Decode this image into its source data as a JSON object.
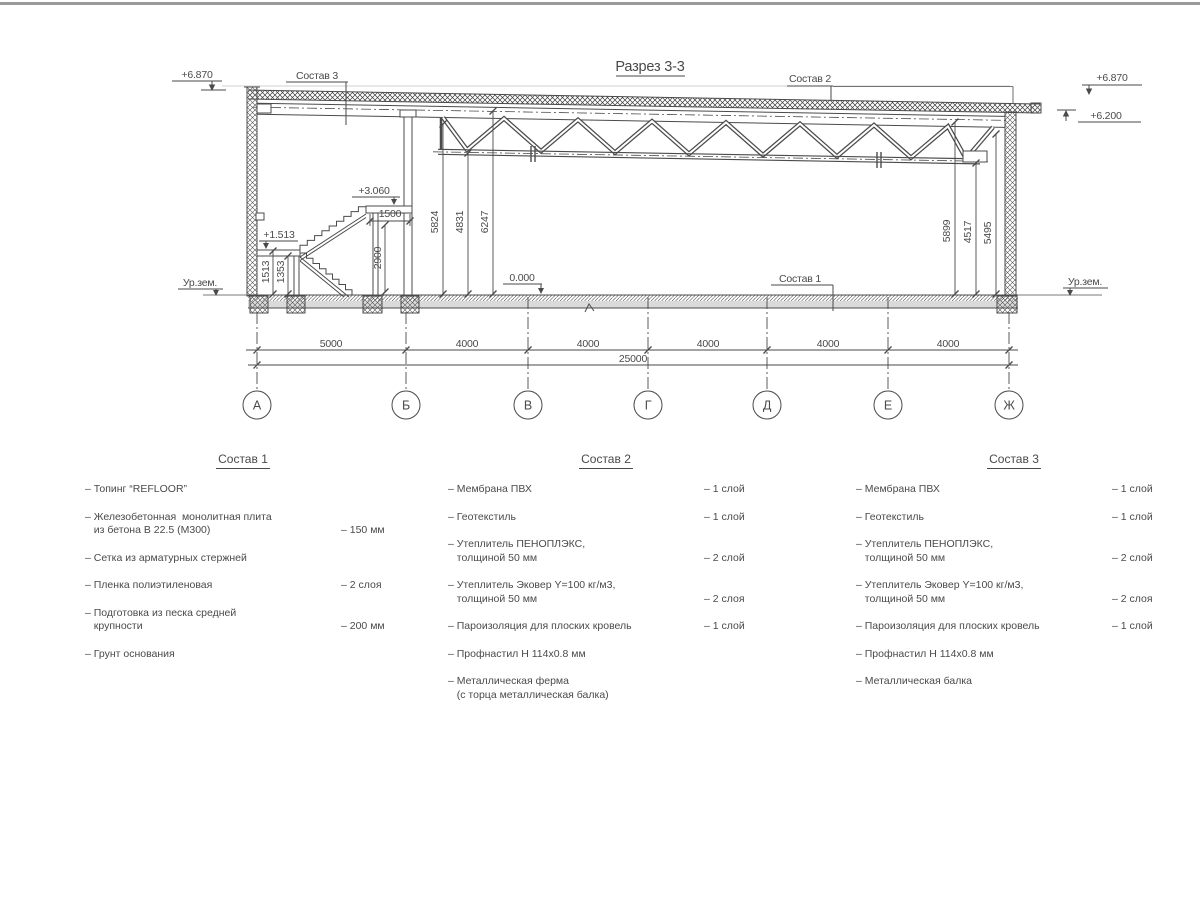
{
  "drawing": {
    "title": "Разрез 3-3",
    "axes": [
      "А",
      "Б",
      "В",
      "Г",
      "Д",
      "Е",
      "Ж"
    ],
    "axis_dims": [
      "5000",
      "4000",
      "4000",
      "4000",
      "4000",
      "4000"
    ],
    "total_dim": "25000",
    "elev_left_top": "+6.870",
    "elev_right_top": "+6.870",
    "elev_right_eave": "+6.200",
    "elev_landing": "+3.060",
    "elev_mid_landing": "+1.513",
    "elev_floor": "0.000",
    "ground_left": "Ур.зем.",
    "ground_right": "Ур.зем.",
    "label_sostav1": "Состав 1",
    "label_sostav2": "Состав 2",
    "label_sostav3": "Состав 3",
    "dim_1513": "1513",
    "dim_1353": "1353",
    "dim_1500": "1500",
    "dim_2900": "2900",
    "dim_5824": "5824",
    "dim_4831": "4831",
    "dim_6247": "6247",
    "dim_5899": "5899",
    "dim_4517": "4517",
    "dim_5495": "5495"
  },
  "specs": [
    {
      "title": "Состав 1",
      "items": [
        {
          "text": "– Топинг “REFLOOR”",
          "value": ""
        },
        {
          "text": "– Железобетонная  монолитная плита\n   из бетона В 22.5 (М300)",
          "value": "– 150 мм"
        },
        {
          "text": "– Сетка из арматурных стержней",
          "value": ""
        },
        {
          "text": "– Пленка полиэтиленовая",
          "value": "–  2 слоя"
        },
        {
          "text": "– Подготовка из песка средней\n   крупности",
          "value": "– 200 мм"
        },
        {
          "text": "– Грунт основания",
          "value": ""
        }
      ]
    },
    {
      "title": "Состав 2",
      "items": [
        {
          "text": "– Мембрана ПВХ",
          "value": "– 1 слой"
        },
        {
          "text": "– Геотекстиль",
          "value": "– 1 слой"
        },
        {
          "text": "– Утеплитель ПЕНОПЛЭКС,\n   толщиной 50 мм",
          "value": "– 2 слой"
        },
        {
          "text": "– Утеплитель Эковер Y=100 кг/м3,\n   толщиной 50 мм",
          "value": "– 2 слоя"
        },
        {
          "text": "– Пароизоляция для плоских кровель",
          "value": "– 1 слой"
        },
        {
          "text": "– Профнастил Н 114х0.8 мм",
          "value": ""
        },
        {
          "text": "– Металлическая ферма\n   (с торца металлическая балка)",
          "value": ""
        }
      ]
    },
    {
      "title": "Состав 3",
      "items": [
        {
          "text": "– Мембрана ПВХ",
          "value": "– 1 слой"
        },
        {
          "text": "– Геотекстиль",
          "value": "– 1 слой"
        },
        {
          "text": "– Утеплитель ПЕНОПЛЭКС,\n   толщиной 50 мм",
          "value": "– 2 слой"
        },
        {
          "text": "– Утеплитель Эковер Y=100 кг/м3,\n   толщиной 50 мм",
          "value": "– 2 слоя"
        },
        {
          "text": "– Пароизоляция для плоских кровель",
          "value": "– 1 слой"
        },
        {
          "text": "– Профнастил Н 114х0.8 мм",
          "value": ""
        },
        {
          "text": "– Металлическая балка",
          "value": ""
        }
      ]
    }
  ]
}
